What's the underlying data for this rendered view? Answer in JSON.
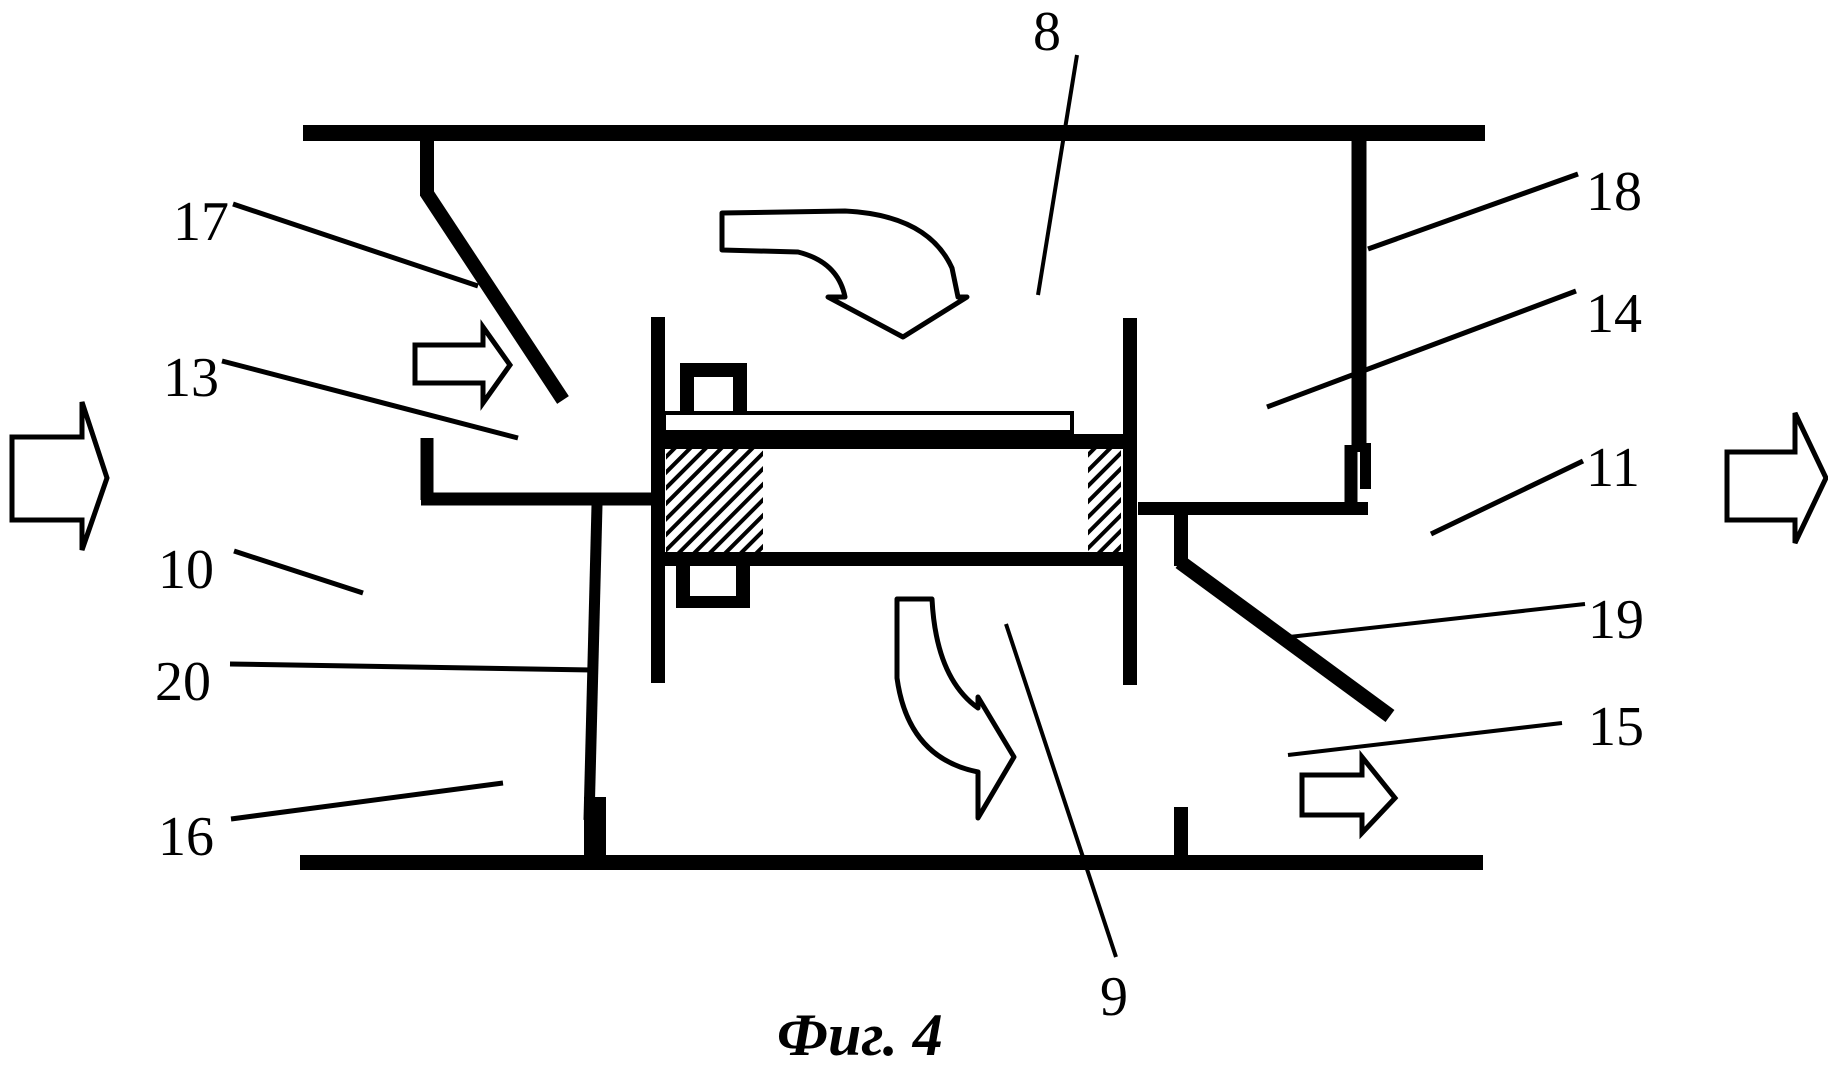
{
  "figure": {
    "type": "patent-line-drawing",
    "caption": "Фиг. 4",
    "ink_color": "#000000",
    "background_color": "#ffffff",
    "labels": [
      {
        "text": "8"
      },
      {
        "text": "17"
      },
      {
        "text": "13"
      },
      {
        "text": "10"
      },
      {
        "text": "20"
      },
      {
        "text": "16"
      },
      {
        "text": "18"
      },
      {
        "text": "14"
      },
      {
        "text": "11"
      },
      {
        "text": "19"
      },
      {
        "text": "15"
      },
      {
        "text": "9"
      }
    ],
    "flow_arrows": [
      "inlet-flow-arrow-left",
      "outlet-flow-arrow-right",
      "upper-duct-small-arrow",
      "lower-duct-small-arrow",
      "upper-curved-flow-arrow",
      "lower-curved-flow-arrow"
    ]
  }
}
